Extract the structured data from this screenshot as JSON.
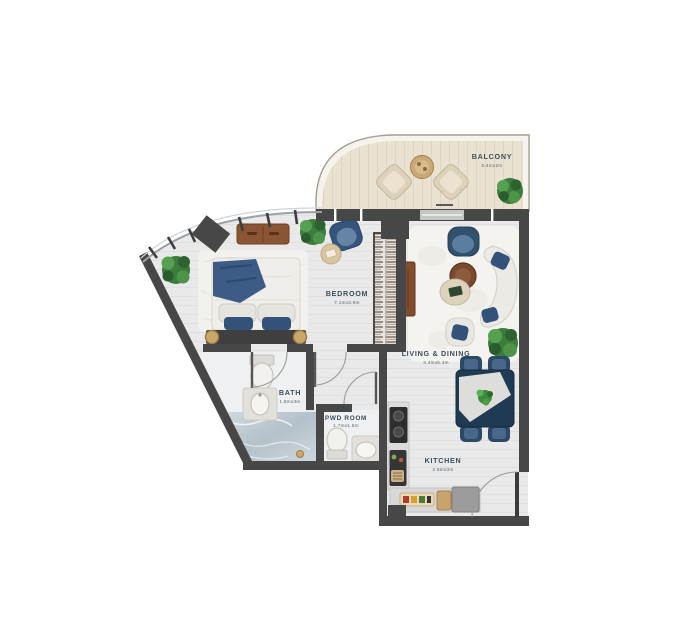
{
  "rooms": {
    "balcony": {
      "label": "BALCONY",
      "dimension": "5.4mx2m"
    },
    "bedroom": {
      "label": "BEDROOM",
      "dimension": "7.1mx3.8m"
    },
    "living_dining": {
      "label": "LIVING & DINING",
      "dimension": "3.4mx5.4m"
    },
    "bath": {
      "label": "BATH",
      "dimension": "1.8mx3m"
    },
    "pwd_room": {
      "label": "PWD ROOM",
      "dimension": "1.7mx1.5m"
    },
    "kitchen": {
      "label": "KITCHEN",
      "dimension": "2.9mx3m"
    }
  },
  "colors": {
    "wall": "#474747",
    "floor": "#e9e9e9",
    "balcony_floor": "#eae2d1",
    "rug": "#f3f2ee",
    "navy": "#35567c",
    "navy_dark": "#22405e",
    "wood": "#8a5534",
    "cream": "#ded2bc",
    "plant_green": "#3c7d3e",
    "marble": "#c3ccd3",
    "label_text": "#3d4e5c"
  }
}
